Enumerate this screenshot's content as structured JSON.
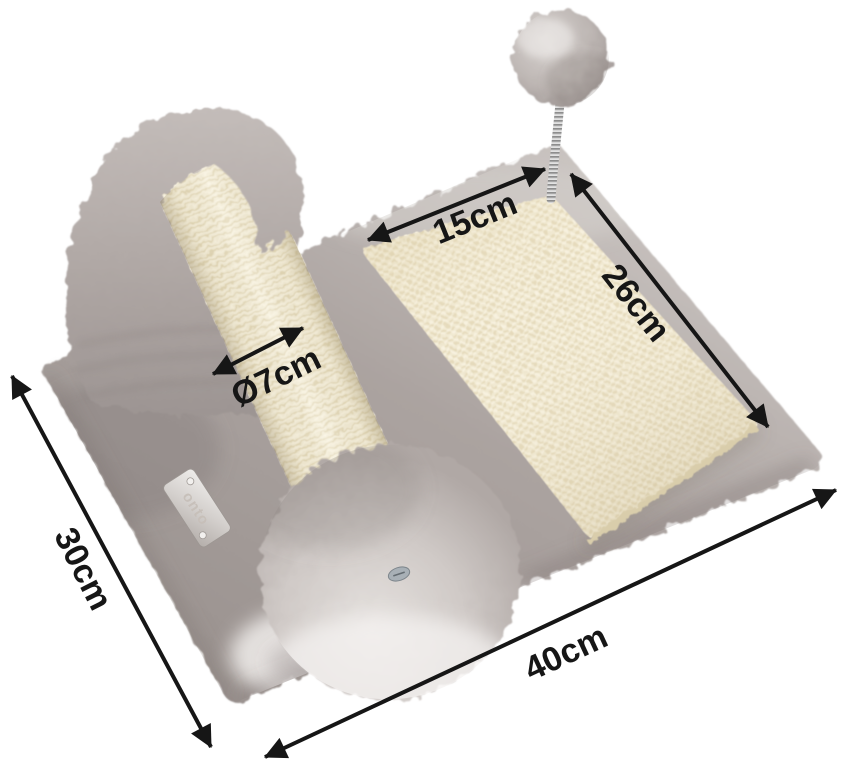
{
  "image": {
    "type": "annotated product photo",
    "subject": "plush cat scratching post set with sisal post, arch, scratch board and spring pompom ball",
    "background_color": "#ffffff"
  },
  "annotations": {
    "board_width_label": "15cm",
    "board_length_label": "26cm",
    "post_diameter_label": "Ø7cm",
    "base_depth_label": "30cm",
    "base_width_label": "40cm"
  },
  "brand_tag": {
    "text": "onto"
  },
  "colors": {
    "annotation": "#161616",
    "plush_grey": "#aaa29f",
    "plush_grey_light": "#d5d0cd",
    "plush_grey_dark": "#8e8684",
    "sisal_cream": "#f1e9d2",
    "sisal_shade": "#ddd2b0",
    "spring_silver": "#c6c6c6",
    "tag_silver": "#dcd9d6",
    "screw_metal": "#a8b0b6"
  }
}
